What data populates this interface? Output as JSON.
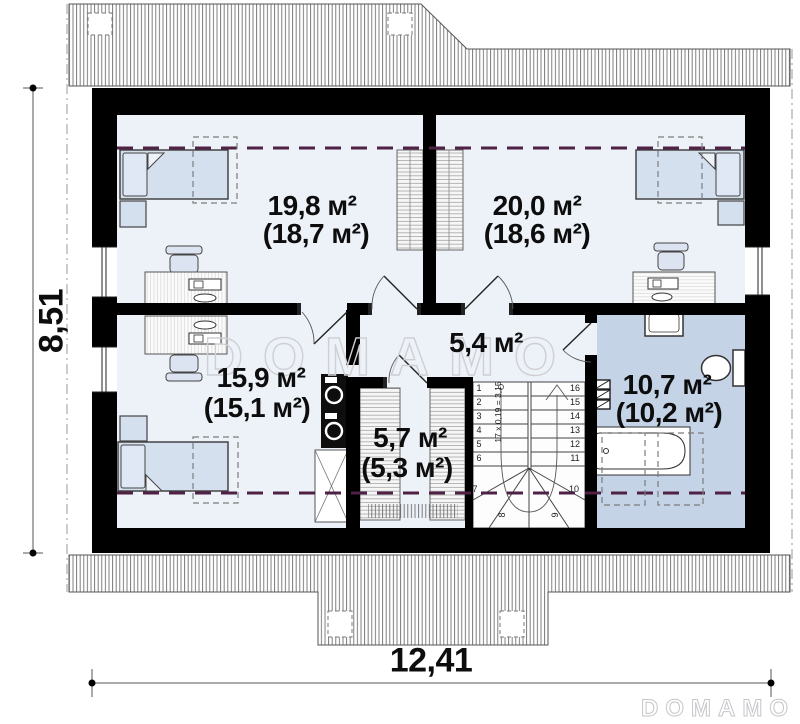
{
  "watermark": {
    "center": "DOMAMO",
    "corner": "DOMAMO"
  },
  "dimensions": {
    "overall_width_m": "12,41",
    "overall_height_m": "8,51"
  },
  "rooms": [
    {
      "id": "bedroom-top-left",
      "area": "19,8 м²",
      "area_net": "(18,7 м²)"
    },
    {
      "id": "bedroom-top-right",
      "area": "20,0 м²",
      "area_net": "(18,6 м²)"
    },
    {
      "id": "hallway",
      "area": "5,4 м²",
      "area_net": ""
    },
    {
      "id": "bedroom-bottom",
      "area": "15,9 м²",
      "area_net": "(15,1 м²)"
    },
    {
      "id": "storage",
      "area": "5,7 м²",
      "area_net": "(5,3 м²)"
    },
    {
      "id": "bathroom",
      "area": "10,7 м²",
      "area_net": "(10,2 м²)"
    }
  ],
  "stairs": {
    "formula": "17 x 0,19 = 3,15",
    "left_numbers": [
      "1",
      "2",
      "3",
      "4",
      "5",
      "6"
    ],
    "right_numbers": [
      "16",
      "15",
      "14",
      "13",
      "12",
      "11"
    ],
    "winder_numbers": [
      "7",
      "8",
      "9",
      "10"
    ]
  },
  "colors": {
    "wall": "#000000",
    "room_floor": "#edf1f8",
    "bathroom_floor": "#c5d3e7",
    "furniture_fill": "#d5e0ef",
    "knee_wall_dash": "#4e2145",
    "roof_hatch_line": "#6f6f6f",
    "watermark": "#cfcfd4"
  }
}
